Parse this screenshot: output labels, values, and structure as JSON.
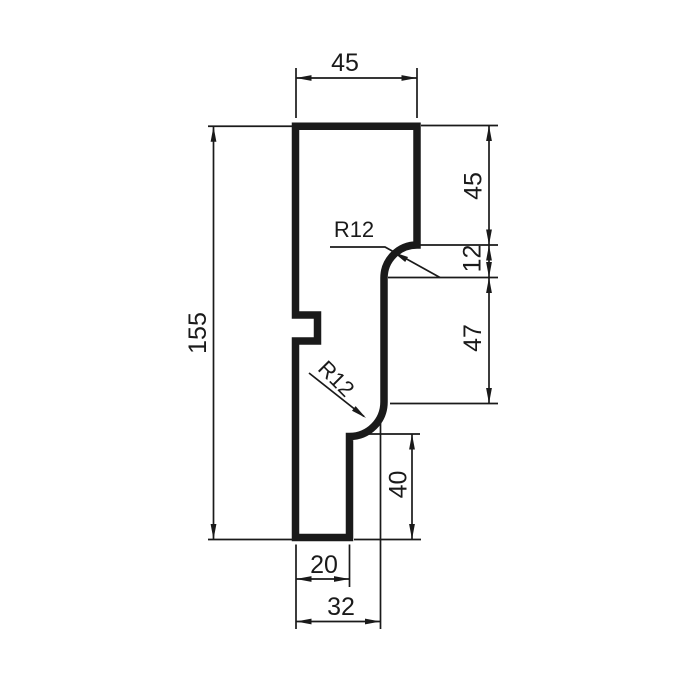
{
  "drawing": {
    "type": "technical-drawing",
    "subject": "molding-profile-cross-section",
    "background_color": "#ffffff",
    "line_color": "#1a1a1a",
    "labels": {
      "top_width": "45",
      "right_upper_height": "45",
      "step_height": "12",
      "middle_height": "47",
      "lower_right_height": "40",
      "total_height": "155",
      "bottom_width": "20",
      "bottom_step_width": "32",
      "upper_radius": "R12",
      "lower_radius": "R12"
    }
  }
}
